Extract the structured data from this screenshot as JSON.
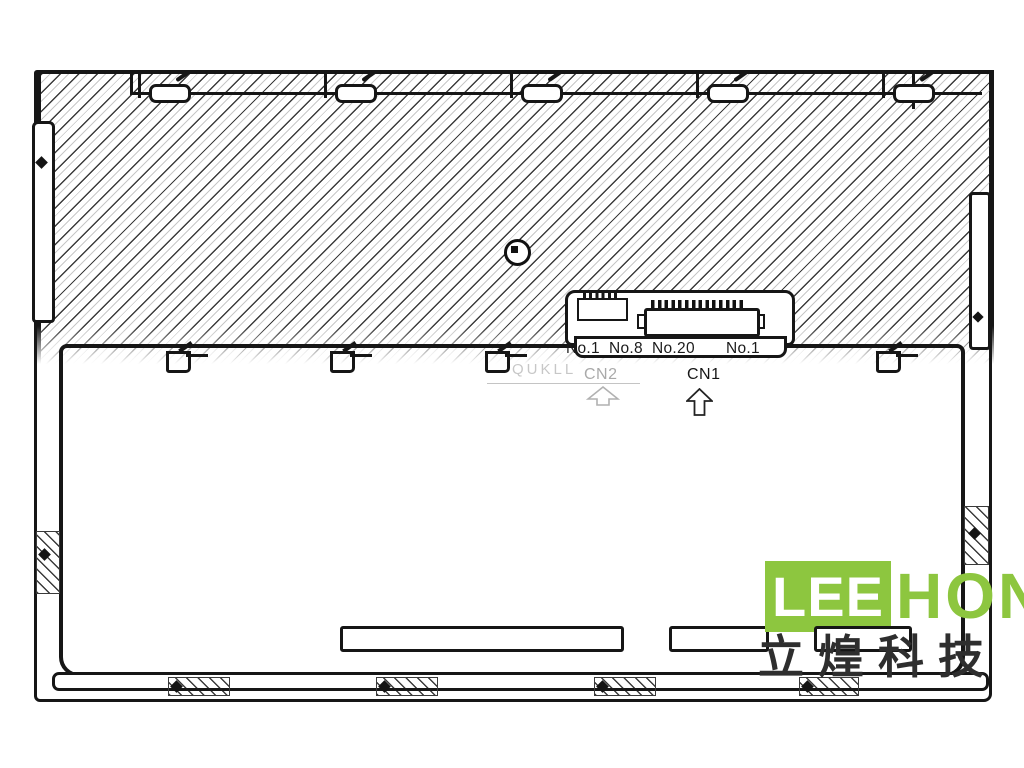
{
  "drawing": {
    "connector_area": {
      "pin_labels": [
        "No.1",
        "No.8",
        "No.20",
        "No.1"
      ],
      "cn2_label": "CN2",
      "cn1_label": "CN1",
      "watermark_text": "QUKLL"
    },
    "logo": {
      "lee_text": "LEE",
      "hon_text": "HON",
      "chinese_text": "立煌科技",
      "brand_green": "#8DC63F",
      "chinese_color": "#2e2e2e"
    },
    "colors": {
      "line": "#161616",
      "background": "#ffffff"
    }
  }
}
